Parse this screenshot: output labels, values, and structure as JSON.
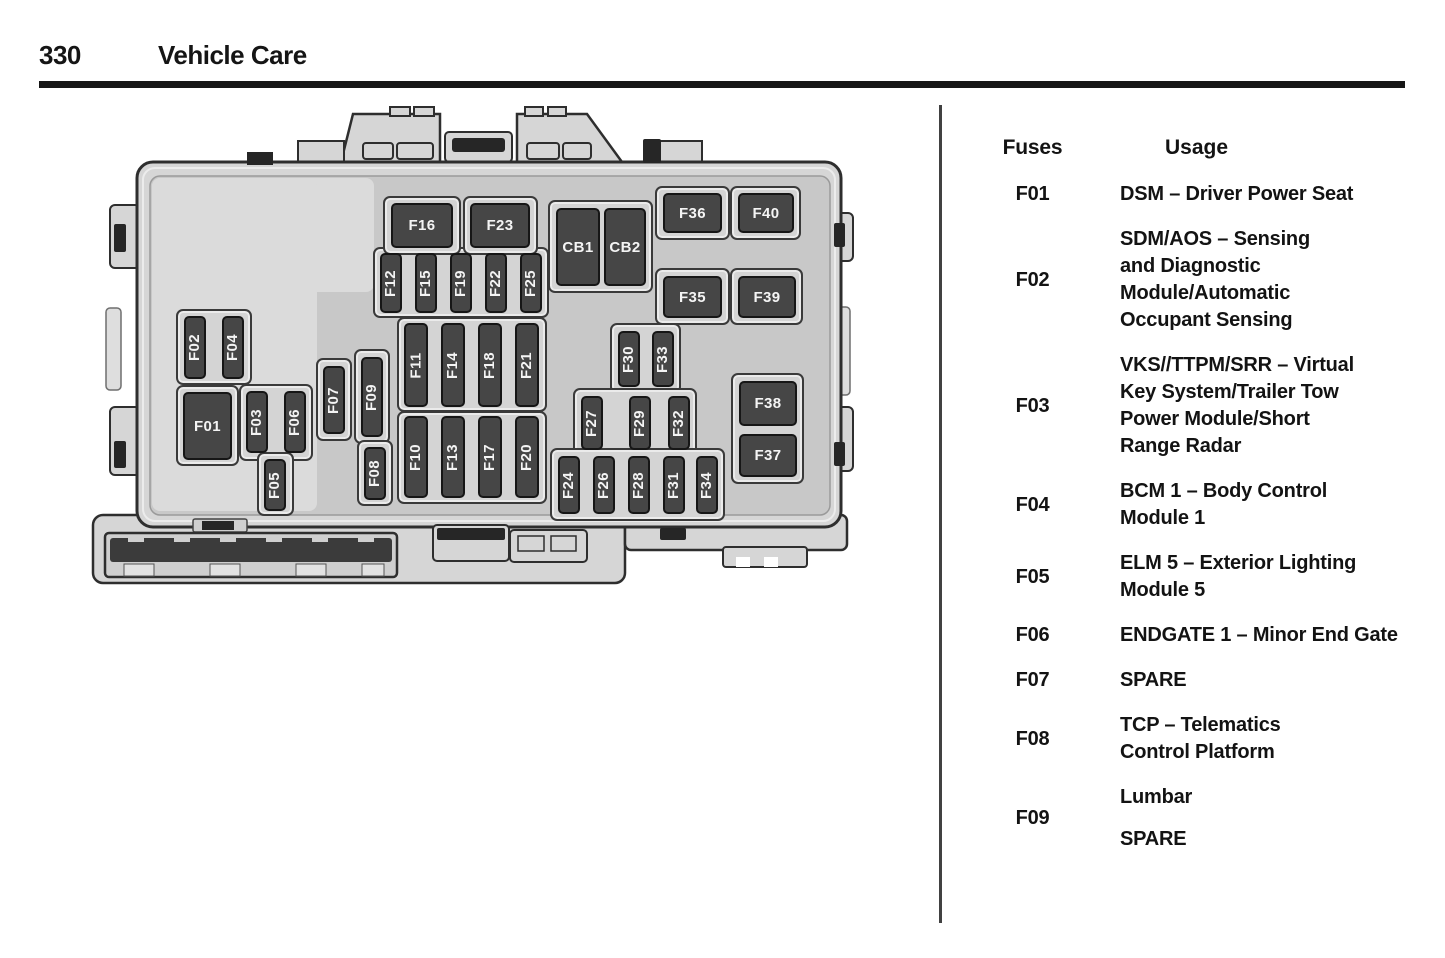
{
  "page": {
    "number": "330",
    "section": "Vehicle Care"
  },
  "table": {
    "header": {
      "fuses": "Fuses",
      "usage": "Usage"
    },
    "rows": [
      {
        "fuse": "F01",
        "usage": [
          "DSM – Driver Power Seat"
        ]
      },
      {
        "fuse": "F02",
        "usage": [
          "SDM/AOS – Sensing",
          "and Diagnostic",
          "Module/Automatic",
          "Occupant Sensing"
        ]
      },
      {
        "fuse": "F03",
        "usage": [
          "VKS//TTPM/SRR – Virtual",
          "Key System/Trailer Tow",
          "Power Module/Short",
          "Range Radar"
        ]
      },
      {
        "fuse": "F04",
        "usage": [
          "BCM 1 – Body Control",
          "Module 1"
        ]
      },
      {
        "fuse": "F05",
        "usage": [
          "ELM 5 – Exterior Lighting",
          "Module 5"
        ]
      },
      {
        "fuse": "F06",
        "usage": [
          "ENDGATE 1 – Minor End Gate"
        ]
      },
      {
        "fuse": "F07",
        "usage": [
          "SPARE"
        ]
      },
      {
        "fuse": "F08",
        "usage": [
          "TCP – Telematics",
          "Control Platform"
        ]
      },
      {
        "fuse": "F09",
        "usage": [
          "Lumbar",
          "",
          "SPARE"
        ]
      }
    ]
  },
  "diagram": {
    "sockets": [
      {
        "x": 86,
        "y": 204,
        "w": 76,
        "h": 76
      },
      {
        "x": 86,
        "y": 280,
        "w": 63,
        "h": 81
      },
      {
        "x": 149,
        "y": 279,
        "w": 74,
        "h": 77
      },
      {
        "x": 167,
        "y": 347,
        "w": 37,
        "h": 64
      },
      {
        "x": 226,
        "y": 253,
        "w": 36,
        "h": 83
      },
      {
        "x": 264,
        "y": 244,
        "w": 36,
        "h": 95
      },
      {
        "x": 267,
        "y": 335,
        "w": 36,
        "h": 66
      },
      {
        "x": 283,
        "y": 142,
        "w": 176,
        "h": 71
      },
      {
        "x": 307,
        "y": 212,
        "w": 150,
        "h": 95
      },
      {
        "x": 307,
        "y": 306,
        "w": 150,
        "h": 93
      },
      {
        "x": 293,
        "y": 91,
        "w": 78,
        "h": 59
      },
      {
        "x": 373,
        "y": 91,
        "w": 75,
        "h": 59
      },
      {
        "x": 458,
        "y": 95,
        "w": 105,
        "h": 93
      },
      {
        "x": 565,
        "y": 81,
        "w": 75,
        "h": 54
      },
      {
        "x": 640,
        "y": 81,
        "w": 71,
        "h": 54
      },
      {
        "x": 565,
        "y": 163,
        "w": 75,
        "h": 57
      },
      {
        "x": 640,
        "y": 163,
        "w": 73,
        "h": 57
      },
      {
        "x": 641,
        "y": 268,
        "w": 73,
        "h": 111
      },
      {
        "x": 520,
        "y": 218,
        "w": 71,
        "h": 71
      },
      {
        "x": 483,
        "y": 283,
        "w": 124,
        "h": 69
      },
      {
        "x": 460,
        "y": 343,
        "w": 175,
        "h": 73
      }
    ],
    "fuses": [
      {
        "id": "F01",
        "x": 93,
        "y": 287,
        "w": 49,
        "h": 68,
        "o": "h"
      },
      {
        "id": "F02",
        "x": 94,
        "y": 211,
        "w": 22,
        "h": 63,
        "o": "v"
      },
      {
        "id": "F04",
        "x": 132,
        "y": 211,
        "w": 22,
        "h": 63,
        "o": "v"
      },
      {
        "id": "F03",
        "x": 156,
        "y": 286,
        "w": 22,
        "h": 62,
        "o": "v"
      },
      {
        "id": "F06",
        "x": 194,
        "y": 286,
        "w": 22,
        "h": 62,
        "o": "v"
      },
      {
        "id": "F05",
        "x": 174,
        "y": 354,
        "w": 22,
        "h": 52,
        "o": "v"
      },
      {
        "id": "F07",
        "x": 233,
        "y": 261,
        "w": 22,
        "h": 68,
        "o": "v"
      },
      {
        "id": "F09",
        "x": 271,
        "y": 252,
        "w": 22,
        "h": 80,
        "o": "v"
      },
      {
        "id": "F08",
        "x": 274,
        "y": 342,
        "w": 22,
        "h": 53,
        "o": "v"
      },
      {
        "id": "F12",
        "x": 290,
        "y": 148,
        "w": 22,
        "h": 60,
        "o": "v"
      },
      {
        "id": "F15",
        "x": 325,
        "y": 148,
        "w": 22,
        "h": 60,
        "o": "v"
      },
      {
        "id": "F19",
        "x": 360,
        "y": 148,
        "w": 22,
        "h": 60,
        "o": "v"
      },
      {
        "id": "F22",
        "x": 395,
        "y": 148,
        "w": 22,
        "h": 60,
        "o": "v"
      },
      {
        "id": "F25",
        "x": 430,
        "y": 148,
        "w": 22,
        "h": 60,
        "o": "v"
      },
      {
        "id": "F11",
        "x": 314,
        "y": 218,
        "w": 24,
        "h": 84,
        "o": "v"
      },
      {
        "id": "F14",
        "x": 351,
        "y": 218,
        "w": 24,
        "h": 84,
        "o": "v"
      },
      {
        "id": "F18",
        "x": 388,
        "y": 218,
        "w": 24,
        "h": 84,
        "o": "v"
      },
      {
        "id": "F21",
        "x": 425,
        "y": 218,
        "w": 24,
        "h": 84,
        "o": "v"
      },
      {
        "id": "F10",
        "x": 314,
        "y": 311,
        "w": 24,
        "h": 82,
        "o": "v"
      },
      {
        "id": "F13",
        "x": 351,
        "y": 311,
        "w": 24,
        "h": 82,
        "o": "v"
      },
      {
        "id": "F17",
        "x": 388,
        "y": 311,
        "w": 24,
        "h": 82,
        "o": "v"
      },
      {
        "id": "F20",
        "x": 425,
        "y": 311,
        "w": 24,
        "h": 82,
        "o": "v"
      },
      {
        "id": "F16",
        "x": 301,
        "y": 98,
        "w": 62,
        "h": 45,
        "o": "h"
      },
      {
        "id": "F23",
        "x": 380,
        "y": 98,
        "w": 60,
        "h": 45,
        "o": "h"
      },
      {
        "id": "CB1",
        "x": 466,
        "y": 103,
        "w": 44,
        "h": 78,
        "o": "h"
      },
      {
        "id": "CB2",
        "x": 514,
        "y": 103,
        "w": 42,
        "h": 78,
        "o": "h"
      },
      {
        "id": "F36",
        "x": 573,
        "y": 88,
        "w": 59,
        "h": 40,
        "o": "h"
      },
      {
        "id": "F40",
        "x": 648,
        "y": 88,
        "w": 56,
        "h": 40,
        "o": "h"
      },
      {
        "id": "F35",
        "x": 573,
        "y": 171,
        "w": 59,
        "h": 42,
        "o": "h"
      },
      {
        "id": "F39",
        "x": 648,
        "y": 171,
        "w": 58,
        "h": 42,
        "o": "h"
      },
      {
        "id": "F38",
        "x": 649,
        "y": 276,
        "w": 58,
        "h": 45,
        "o": "h"
      },
      {
        "id": "F37",
        "x": 649,
        "y": 329,
        "w": 58,
        "h": 43,
        "o": "h"
      },
      {
        "id": "F30",
        "x": 528,
        "y": 226,
        "w": 22,
        "h": 56,
        "o": "v"
      },
      {
        "id": "F33",
        "x": 562,
        "y": 226,
        "w": 22,
        "h": 56,
        "o": "v"
      },
      {
        "id": "F27",
        "x": 491,
        "y": 291,
        "w": 22,
        "h": 54,
        "o": "v"
      },
      {
        "id": "F29",
        "x": 539,
        "y": 291,
        "w": 22,
        "h": 54,
        "o": "v"
      },
      {
        "id": "F32",
        "x": 578,
        "y": 291,
        "w": 22,
        "h": 54,
        "o": "v"
      },
      {
        "id": "F24",
        "x": 468,
        "y": 351,
        "w": 22,
        "h": 58,
        "o": "v"
      },
      {
        "id": "F26",
        "x": 503,
        "y": 351,
        "w": 22,
        "h": 58,
        "o": "v"
      },
      {
        "id": "F28",
        "x": 538,
        "y": 351,
        "w": 22,
        "h": 58,
        "o": "v"
      },
      {
        "id": "F31",
        "x": 573,
        "y": 351,
        "w": 22,
        "h": 58,
        "o": "v"
      },
      {
        "id": "F34",
        "x": 606,
        "y": 351,
        "w": 22,
        "h": 58,
        "o": "v"
      }
    ]
  },
  "colors": {
    "ink": "#151515",
    "fuse_fill": "#464646",
    "fuse_text": "#f4f4f4",
    "body_fill": "#d6d6d6",
    "panel_fill": "#c8c8c8",
    "light_region": "#dbdbdb",
    "outline": "#2e2e2e"
  }
}
